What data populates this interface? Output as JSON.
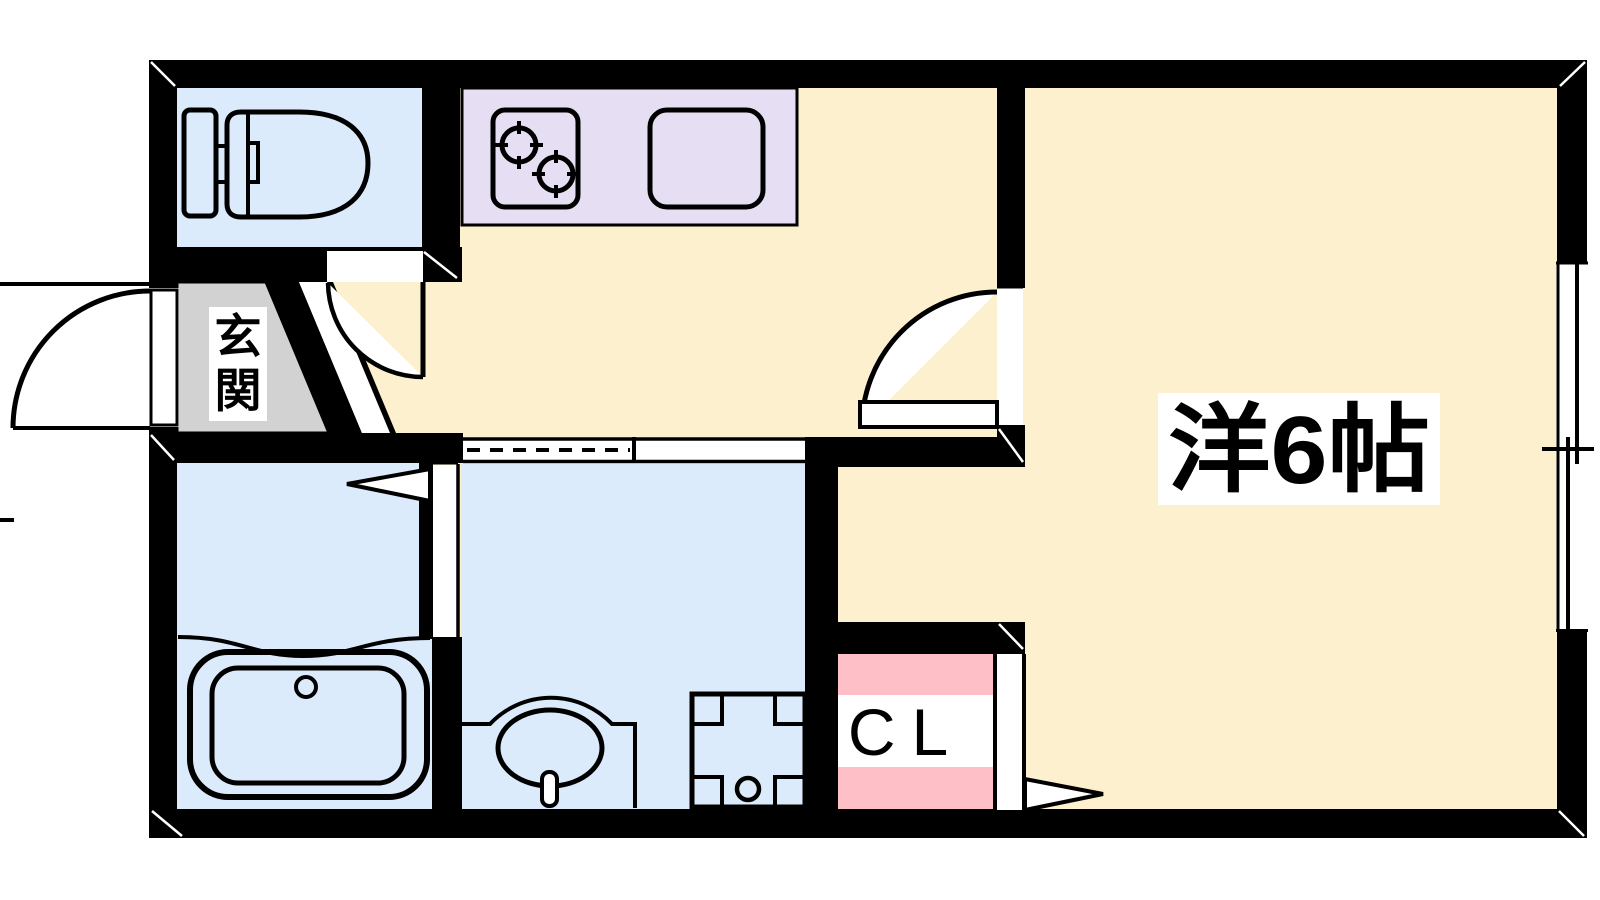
{
  "plan": {
    "type": "apartment-floor-plan",
    "rooms": {
      "western_room": {
        "label": "洋6帖",
        "meaning": "western-style room 6 mats"
      },
      "genkan": {
        "label": "玄関",
        "chars": [
          "玄",
          "関"
        ],
        "meaning": "entrance"
      },
      "closet": {
        "label": "CL"
      },
      "kitchen": {
        "label": ""
      },
      "toilet": {
        "label": ""
      },
      "bathroom": {
        "label": ""
      },
      "washroom": {
        "label": ""
      }
    },
    "fixtures": [
      "toilet",
      "gas-stove-2-burner",
      "kitchen-sink",
      "bathtub",
      "washbasin",
      "washing-machine-pan",
      "entrance-door",
      "toilet-door",
      "room-hinged-door",
      "folding-bath-door",
      "folding-closet-door",
      "sliding-door",
      "sliding-window"
    ],
    "colors": {
      "wall": "#000000",
      "floor": "#fdf0ce",
      "water_room": "#dcebfc",
      "kitchen_counter": "#e6dff3",
      "genkan_floor": "#d2d2d2",
      "closet": "#ffbfc6",
      "label_bg": "#ffffff",
      "line": "#000000"
    }
  }
}
